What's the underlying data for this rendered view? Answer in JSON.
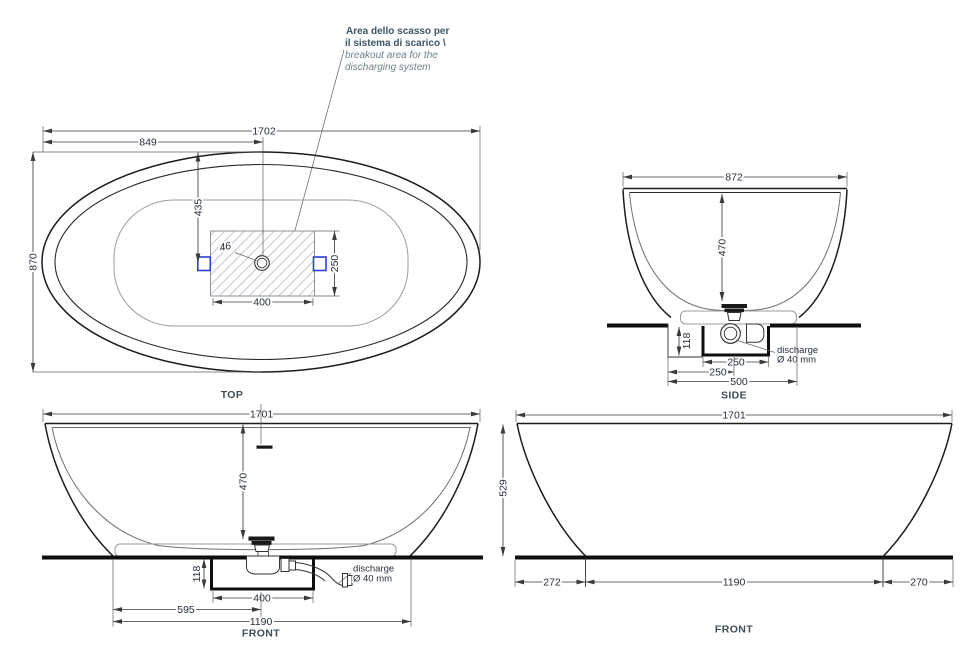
{
  "annotation": {
    "it1": "Area dello scasso per",
    "it2": "il sistema di scarico \\",
    "en1": "breakout area for the",
    "en2": "discharging system"
  },
  "views": {
    "top": {
      "label": "TOP",
      "dim_length": "1702",
      "dim_half_length": "849",
      "dim_width": "870",
      "dim_drain_y": "435",
      "dim_box_w": "400",
      "dim_box_h": "250",
      "dim_hole": "46"
    },
    "side": {
      "label": "SIDE",
      "dim_top_width": "872",
      "dim_depth": "470",
      "dim_recess_depth": "118",
      "dim_trap_box": "250",
      "dim_half_recess": "250",
      "dim_recess": "500",
      "discharge1": "discharge",
      "discharge2": "Ø 40 mm"
    },
    "front": {
      "label": "FRONT",
      "dim_length": "1701",
      "dim_depth": "470",
      "dim_recess_depth": "118",
      "dim_box": "400",
      "dim_half_base": "595",
      "dim_base": "1190",
      "discharge1": "discharge",
      "discharge2": "Ø 40 mm"
    },
    "front2": {
      "label": "FRONT",
      "dim_length": "1701",
      "dim_height": "529",
      "dim_left": "272",
      "dim_base": "1190",
      "dim_right": "270"
    }
  },
  "colors": {
    "outline": "#1c1c1c",
    "dim_text": "#272e3c",
    "annotation_primary": "#3b5565",
    "annotation_secondary": "#6e7f8a",
    "accent_blue": "#2c3fd4"
  }
}
